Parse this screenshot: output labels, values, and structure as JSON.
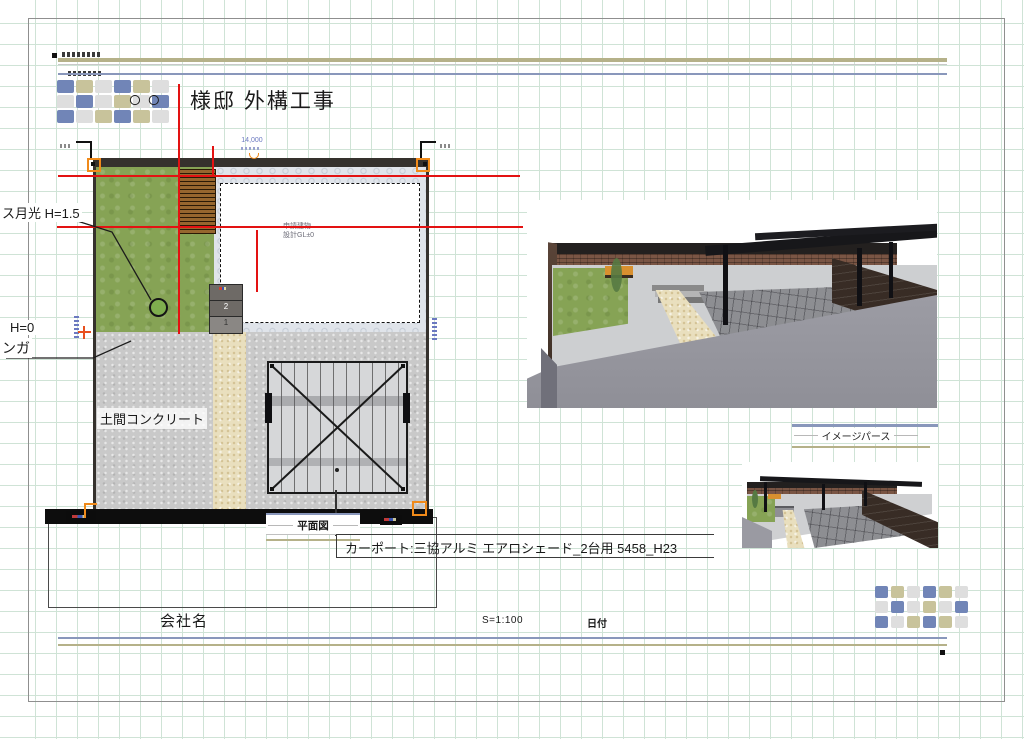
{
  "sheet": {
    "title_prefix": "○○",
    "title": "様邸  外構工事",
    "company": "会社名",
    "scale": "S=1:100",
    "date_label": "日付"
  },
  "plan": {
    "caption": "平面図",
    "dim_top": "14,000",
    "carport_note": "カーポート:三協アルミ エアロシェード_2台用 5458_H23",
    "labels": {
      "fence": "ス月光 H=1.5",
      "height_zero": "H=0",
      "brick": "ンガ",
      "doma": "土間コンクリート"
    },
    "building": {
      "line1": "申請建物",
      "line2": "設計GL±0"
    },
    "steps": {
      "upper": "2",
      "lower": "1"
    }
  },
  "perspective": {
    "caption": "イメージパース"
  },
  "logo": {
    "palette": {
      "b": "#7185b7",
      "k": "#c8c39b",
      "g": "#dedede"
    },
    "pattern": [
      "bkgbkg",
      "gbgkgb",
      "bgkbkg"
    ]
  },
  "colors": {
    "grid": "#cfe3d6",
    "band_olive": "#b5b189",
    "band_blue": "#8997bb",
    "construction_red": "#e31212",
    "marker_orange": "#f08a1a",
    "lawn_green": "#86a355",
    "concrete_gray": "#c9c9c9"
  }
}
